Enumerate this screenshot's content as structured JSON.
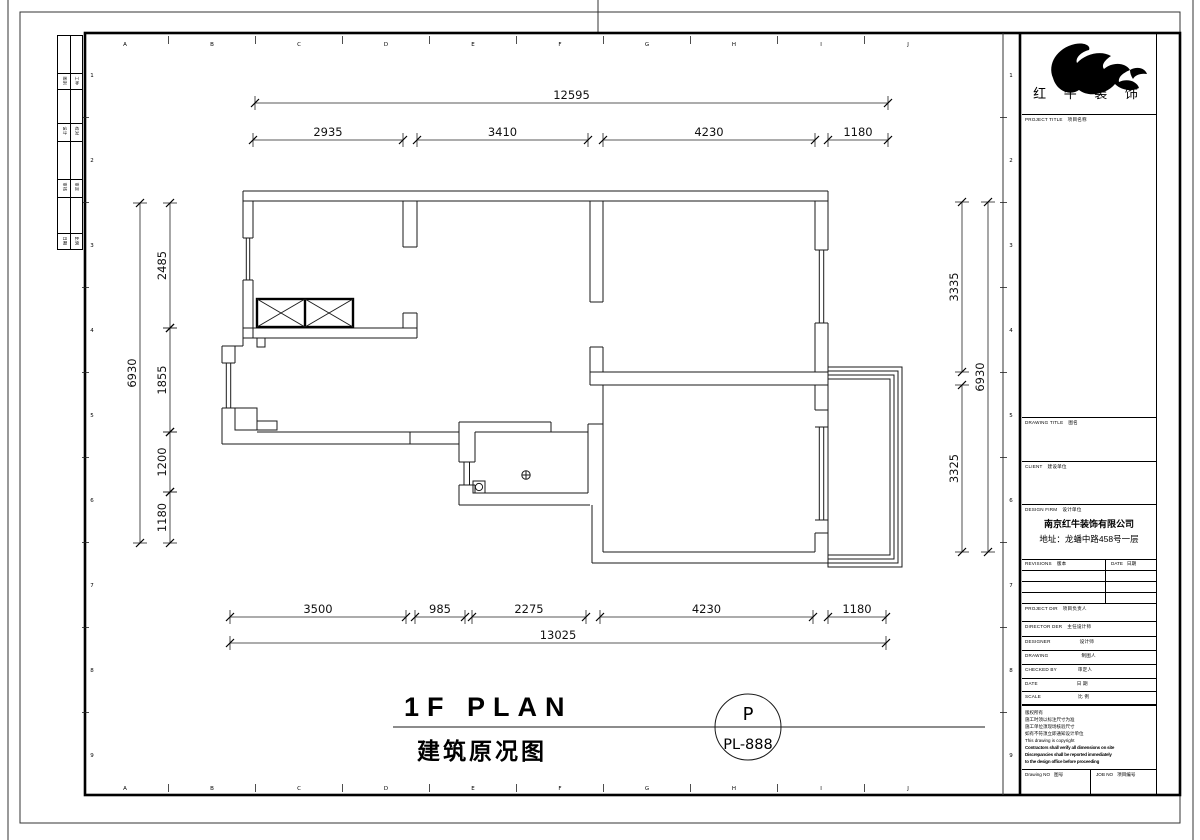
{
  "sheet": {
    "grid": {
      "col_letters": [
        "A",
        "B",
        "C",
        "D",
        "E",
        "F",
        "G",
        "H",
        "I",
        "J"
      ],
      "row_numbers": [
        "1",
        "2",
        "3",
        "4",
        "5",
        "6",
        "7",
        "8",
        "9"
      ]
    },
    "edge_strip": {
      "rows": [
        [
          "图别",
          "工种"
        ],
        [
          "设计",
          "校对"
        ],
        [
          "审核",
          "审定"
        ],
        [
          "日期",
          "比例"
        ]
      ]
    }
  },
  "plan": {
    "title_en": "1F PLAN",
    "title_cn": "建筑原况图",
    "sheet_ref_top": "P",
    "sheet_ref_bottom": "PL-888",
    "dimensions": [
      {
        "t": "12595",
        "o": "h",
        "a": 255,
        "b": 888,
        "y": 103
      },
      {
        "t": "2935",
        "o": "h",
        "a": 253,
        "b": 403,
        "y": 140
      },
      {
        "t": "3410",
        "o": "h",
        "a": 417,
        "b": 588,
        "y": 140
      },
      {
        "t": "4230",
        "o": "h",
        "a": 603,
        "b": 815,
        "y": 140
      },
      {
        "t": "1180",
        "o": "h",
        "a": 828,
        "b": 888,
        "y": 140
      },
      {
        "t": "3500",
        "o": "h",
        "a": 230,
        "b": 406,
        "y": 617
      },
      {
        "t": "985",
        "o": "h",
        "a": 415,
        "b": 465,
        "y": 617
      },
      {
        "t": "2275",
        "o": "h",
        "a": 472,
        "b": 586,
        "y": 617
      },
      {
        "t": "4230",
        "o": "h",
        "a": 600,
        "b": 813,
        "y": 617
      },
      {
        "t": "1180",
        "o": "h",
        "a": 828,
        "b": 886,
        "y": 617
      },
      {
        "t": "13025",
        "o": "h",
        "a": 230,
        "b": 886,
        "y": 643
      },
      {
        "t": "2485",
        "o": "v",
        "a": 203,
        "b": 328,
        "x": 170
      },
      {
        "t": "1855",
        "o": "v",
        "a": 328,
        "b": 432,
        "x": 170
      },
      {
        "t": "1200",
        "o": "v",
        "a": 432,
        "b": 492,
        "x": 170
      },
      {
        "t": "1180",
        "o": "v",
        "a": 492,
        "b": 543,
        "x": 170
      },
      {
        "t": "6930",
        "o": "v",
        "a": 203,
        "b": 543,
        "x": 140
      },
      {
        "t": "3335",
        "o": "v",
        "a": 202,
        "b": 372,
        "x": 962
      },
      {
        "t": "3325",
        "o": "v",
        "a": 385,
        "b": 552,
        "x": 962
      },
      {
        "t": "6930",
        "o": "v",
        "a": 202,
        "b": 552,
        "x": 988
      }
    ]
  },
  "title_block": {
    "logo_text": "红 牛 装 饰",
    "project_title_en": "PROJECT TITLE",
    "project_title_cn": "项目名称",
    "drawing_title_en": "DRAWING TITLE",
    "drawing_title_cn": "图名",
    "client_en": "CLIENT",
    "client_cn": "建设单位",
    "design_firm_en": "DESIGN FIRM",
    "design_firm_cn": "设计单位",
    "firm_name": "南京红牛装饰有限公司",
    "firm_address": "地址：龙蟠中路458号一层",
    "revisions_en": "REVISIONS",
    "revisions_cn": "版本",
    "date_col_en": "DATE",
    "date_col_cn": "日期",
    "rows": [
      {
        "en": "PROJECT DIR",
        "cn": "项目负责人"
      },
      {
        "en": "DIRECTOR DER",
        "cn": "主任设计师"
      },
      {
        "en": "DESIGNER",
        "cn": "设计师"
      },
      {
        "en": "DRAWING",
        "cn": "制图人"
      },
      {
        "en": "CHECKED BY",
        "cn": "审定人"
      },
      {
        "en": "DATE",
        "cn": "日 期"
      },
      {
        "en": "SCALE",
        "cn": "比 例"
      }
    ],
    "notes": [
      "版权所有",
      "施工时须以标注尺寸为准",
      "施工单位须现场核验尺寸",
      "如有不符须立即通知设计单位",
      "This drawing is copyright",
      "Contractors shall verify all dimensions on site",
      "Discrepancies shall be reported immediately",
      "to the design office before proceeding"
    ],
    "drawing_no_en": "Drawing NO",
    "drawing_no_cn": "图号",
    "job_no_en": "JOB NO",
    "job_no_cn": "项目编号"
  }
}
